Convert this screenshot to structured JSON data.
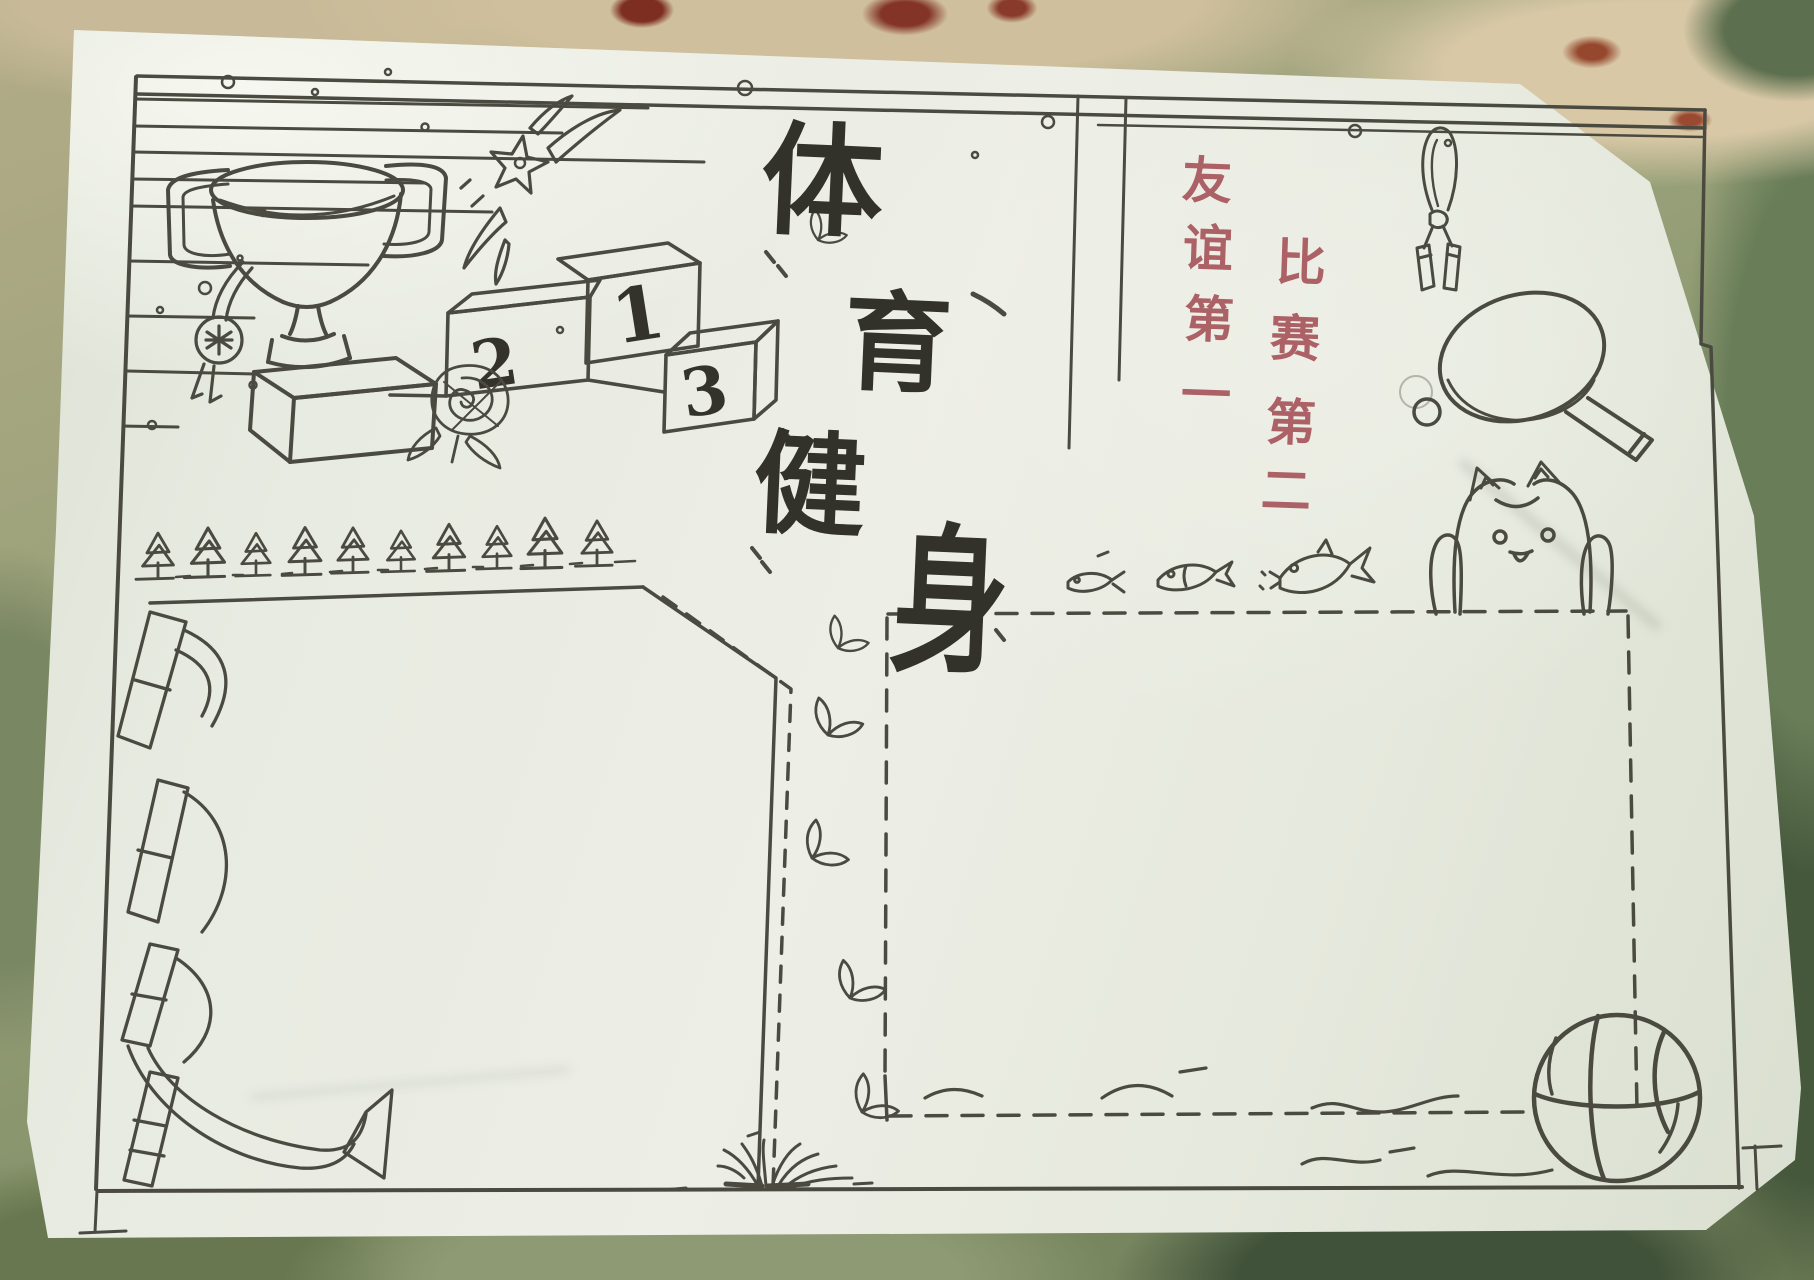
{
  "poster": {
    "title_chars": [
      "体",
      "育",
      "健",
      "身"
    ],
    "title_text": "体育健身",
    "slogan_column_1": [
      "友",
      "谊",
      "第",
      "一"
    ],
    "slogan_column_2": [
      "比",
      "赛",
      "第",
      "二"
    ],
    "slogan_text": "友谊第一 比赛第二",
    "podium_numbers": [
      "1",
      "2",
      "3"
    ],
    "colors": {
      "ink": "#4a4a40",
      "title_ink": "#32312a",
      "slogan_red": "#ab6165",
      "paper": "#e9ebe2",
      "background_green": "#7f8d66",
      "background_tan": "#cfbf9c"
    },
    "drawings": [
      "speed-lines",
      "trophy",
      "medal",
      "shooting-star",
      "winners-podium",
      "rose",
      "pine-tree-row",
      "ribbon-scroll",
      "jump-rope",
      "table-tennis-paddle",
      "table-tennis-ball",
      "cat",
      "fish-trio",
      "leaf-sprigs",
      "grass-tuft",
      "water-waves",
      "basketball",
      "left-text-box",
      "right-text-box"
    ]
  }
}
